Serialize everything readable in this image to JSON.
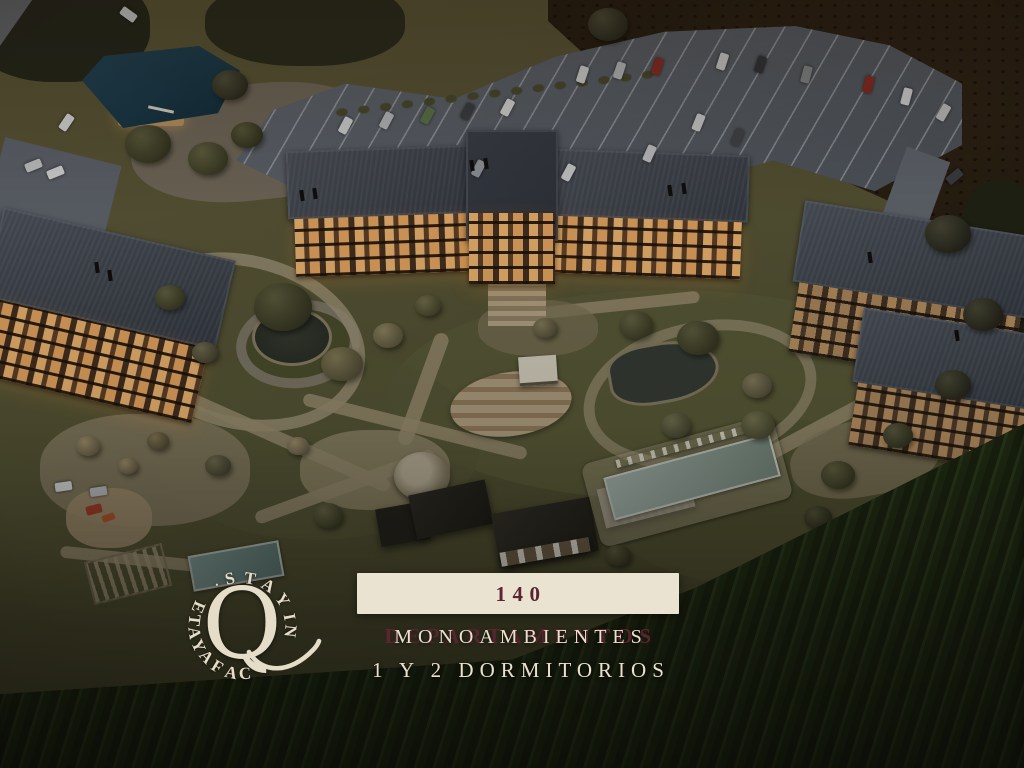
{
  "overlay": {
    "badge_text": "140 DEPARTAMENTOS",
    "subtitle_line1": "MONOAMBIENTES",
    "subtitle_line2": "1 Y 2 DORMITORIOS"
  },
  "logo": {
    "center_letter": "Q",
    "arc_text_top": "· STAY IN",
    "arc_text_bottom": "CAFAYATE",
    "full_text": "STAY IN Q CAFAYATE"
  },
  "colors": {
    "badge_background": "#ebe3d2",
    "badge_text": "#5c2530",
    "subtitle_text": "#e9e0cd",
    "logo_text": "#e6ddc9"
  }
}
